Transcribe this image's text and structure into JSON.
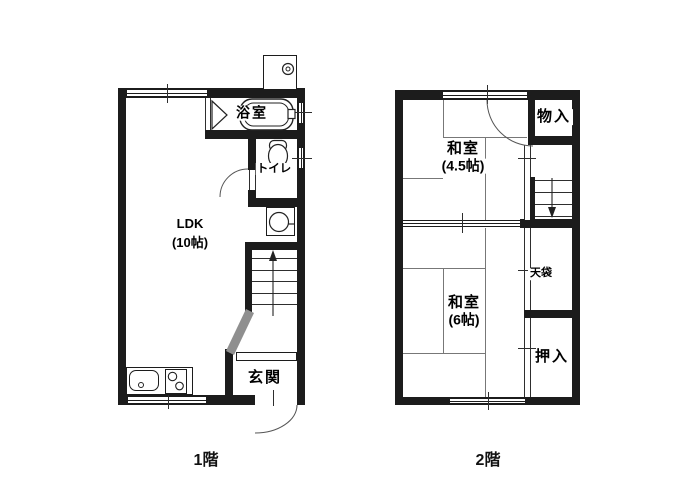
{
  "title": "2-story apartment floor plan",
  "colors": {
    "wall": "#1c1c1c",
    "thin_line": "#2e2e2e",
    "tatami_line": "#777777",
    "stair_diagonal": "#8f8f8f",
    "background": "#ffffff"
  },
  "floor1": {
    "caption": "1階",
    "rooms": {
      "ldk": {
        "name": "LDK",
        "size": "(10帖)"
      },
      "bathroom": {
        "name": "浴室"
      },
      "toilet": {
        "name": "トイレ"
      },
      "entrance": {
        "name": "玄関"
      }
    }
  },
  "floor2": {
    "caption": "2階",
    "rooms": {
      "washitsu_45": {
        "name": "和室",
        "size": "(4.5帖)"
      },
      "storage": {
        "name": "物入"
      },
      "tenbukuro": {
        "name": "天袋"
      },
      "washitsu_6": {
        "name": "和室",
        "size": "(6帖)"
      },
      "oshiire": {
        "name": "押入"
      }
    }
  }
}
